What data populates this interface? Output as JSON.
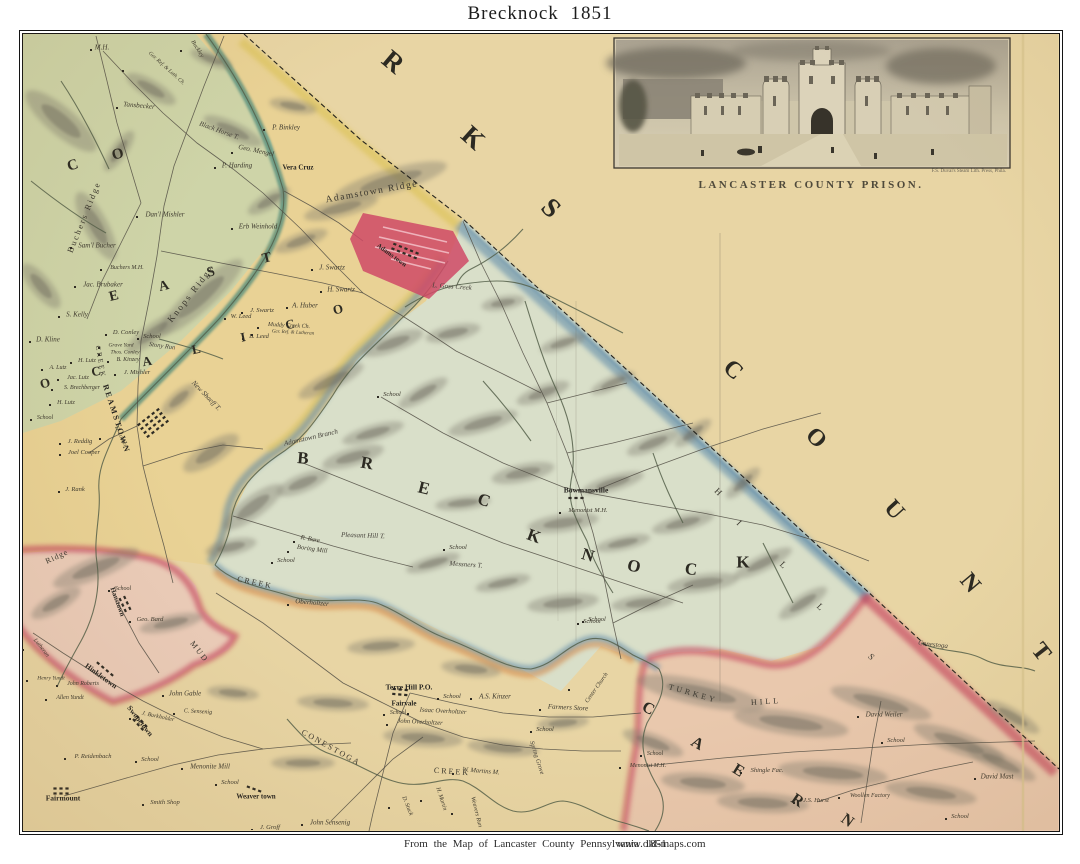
{
  "page": {
    "title": "Brecknock  1851",
    "footer_caption": "From the Map of Lancaster County   Pennsylvania   1851",
    "footer_url": "www.old-maps.com"
  },
  "inset": {
    "caption": "LANCASTER COUNTY PRISON.",
    "credit": "F.S. Duval's Steam Lith. Press, Phila."
  },
  "palette": {
    "paper": "#e8d5a4",
    "east_cocalico": "#e9d193",
    "brecknock": "#d9dfc9",
    "west_cocalico": "#cbd4a8",
    "ephrata_pink": "#ebc9be",
    "caernarvon": "#e9c6ae",
    "adamstown_red": "#cf4a66",
    "boundary_red": "#c6485f",
    "boundary_blue": "#4a7ca3",
    "boundary_yellow": "#d8bf4a",
    "boundary_orange": "#d6823f",
    "creek_teal": "#4e8a7a",
    "ink": "#2e2b24"
  },
  "labels": [
    {
      "t": "R",
      "x": 393,
      "y": 62,
      "r": 40,
      "s": 27,
      "k": "big"
    },
    {
      "t": "K",
      "x": 473,
      "y": 138,
      "r": 42,
      "s": 27,
      "k": "big"
    },
    {
      "t": "S",
      "x": 551,
      "y": 208,
      "r": 45,
      "s": 27,
      "k": "big"
    },
    {
      "t": "C",
      "x": 733,
      "y": 370,
      "r": 42,
      "s": 24,
      "k": "big"
    },
    {
      "t": "O",
      "x": 816,
      "y": 438,
      "r": 45,
      "s": 24,
      "k": "big"
    },
    {
      "t": "U",
      "x": 894,
      "y": 510,
      "r": 48,
      "s": 24,
      "k": "big"
    },
    {
      "t": "N",
      "x": 970,
      "y": 583,
      "r": 50,
      "s": 24,
      "k": "big"
    },
    {
      "t": "T",
      "x": 1041,
      "y": 652,
      "r": 52,
      "s": 24,
      "k": "big"
    },
    {
      "t": "B",
      "x": 303,
      "y": 458,
      "r": 5,
      "s": 17,
      "k": "big"
    },
    {
      "t": "R",
      "x": 367,
      "y": 463,
      "r": 10,
      "s": 17,
      "k": "big"
    },
    {
      "t": "E",
      "x": 424,
      "y": 488,
      "r": 14,
      "s": 17,
      "k": "big"
    },
    {
      "t": "C",
      "x": 484,
      "y": 500,
      "r": 18,
      "s": 17,
      "k": "big"
    },
    {
      "t": "K",
      "x": 534,
      "y": 536,
      "r": 20,
      "s": 17,
      "k": "big"
    },
    {
      "t": "N",
      "x": 588,
      "y": 555,
      "r": 16,
      "s": 17,
      "k": "big"
    },
    {
      "t": "O",
      "x": 634,
      "y": 566,
      "r": 12,
      "s": 17,
      "k": "big"
    },
    {
      "t": "C",
      "x": 691,
      "y": 569,
      "r": 6,
      "s": 17,
      "k": "big"
    },
    {
      "t": "K",
      "x": 743,
      "y": 562,
      "r": 0,
      "s": 17,
      "k": "big"
    },
    {
      "t": "E",
      "x": 114,
      "y": 297,
      "r": -14,
      "s": 14,
      "k": "big"
    },
    {
      "t": "A",
      "x": 164,
      "y": 287,
      "r": -14,
      "s": 14,
      "k": "big"
    },
    {
      "t": "S",
      "x": 211,
      "y": 273,
      "r": -14,
      "s": 14,
      "k": "big"
    },
    {
      "t": "T",
      "x": 267,
      "y": 259,
      "r": -14,
      "s": 14,
      "k": "big"
    },
    {
      "t": "C",
      "x": 16,
      "y": 330,
      "r": -30,
      "s": 13,
      "k": "big"
    },
    {
      "t": "O",
      "x": 45,
      "y": 383,
      "r": -15,
      "s": 13,
      "k": "big"
    },
    {
      "t": "C",
      "x": 96,
      "y": 371,
      "r": -10,
      "s": 13,
      "k": "big"
    },
    {
      "t": "A",
      "x": 147,
      "y": 361,
      "r": -10,
      "s": 13,
      "k": "big"
    },
    {
      "t": "L",
      "x": 196,
      "y": 349,
      "r": -12,
      "s": 13,
      "k": "big"
    },
    {
      "t": "I",
      "x": 243,
      "y": 337,
      "r": -12,
      "s": 13,
      "k": "big"
    },
    {
      "t": "C",
      "x": 290,
      "y": 324,
      "r": -13,
      "s": 13,
      "k": "big"
    },
    {
      "t": "O",
      "x": 338,
      "y": 309,
      "r": -14,
      "s": 13,
      "k": "big"
    },
    {
      "t": "C",
      "x": 73,
      "y": 166,
      "r": -18,
      "s": 15,
      "k": "big"
    },
    {
      "t": "O",
      "x": 118,
      "y": 155,
      "r": -15,
      "s": 15,
      "k": "big"
    },
    {
      "t": "C",
      "x": 648,
      "y": 709,
      "r": 28,
      "s": 16,
      "k": "big"
    },
    {
      "t": "A",
      "x": 697,
      "y": 744,
      "r": 30,
      "s": 16,
      "k": "big"
    },
    {
      "t": "E",
      "x": 738,
      "y": 771,
      "r": 32,
      "s": 16,
      "k": "big"
    },
    {
      "t": "R",
      "x": 797,
      "y": 801,
      "r": 34,
      "s": 16,
      "k": "big"
    },
    {
      "t": "N",
      "x": 847,
      "y": 821,
      "r": 36,
      "s": 16,
      "k": "big"
    },
    {
      "t": "H",
      "x": 718,
      "y": 492,
      "r": 45,
      "s": 9,
      "k": "ridge"
    },
    {
      "t": "I",
      "x": 739,
      "y": 523,
      "r": 45,
      "s": 9,
      "k": "ridge"
    },
    {
      "t": "L",
      "x": 783,
      "y": 565,
      "r": 45,
      "s": 9,
      "k": "ridge"
    },
    {
      "t": "L",
      "x": 820,
      "y": 607,
      "r": 45,
      "s": 9,
      "k": "ridge"
    },
    {
      "t": "S",
      "x": 871,
      "y": 657,
      "r": 45,
      "s": 9,
      "k": "ridge"
    },
    {
      "t": "Adamstown Ridge",
      "x": 372,
      "y": 193,
      "r": -10,
      "s": 9.5,
      "k": "ridge",
      "ls": 1.5
    },
    {
      "t": "Knops Ridge",
      "x": 191,
      "y": 294,
      "r": -52,
      "s": 9,
      "k": "ridge",
      "ls": 2
    },
    {
      "t": "Buchers Ridge",
      "x": 84,
      "y": 217,
      "r": -68,
      "s": 8.5,
      "k": "ridge",
      "ls": 2
    },
    {
      "t": "Ridge",
      "x": 57,
      "y": 557,
      "r": -25,
      "s": 8,
      "k": "ridge",
      "ls": 1
    },
    {
      "t": "TURKEY",
      "x": 693,
      "y": 694,
      "r": 16,
      "s": 8,
      "k": "ridge",
      "ls": 3
    },
    {
      "t": "HILL",
      "x": 766,
      "y": 702,
      "r": -4,
      "s": 8,
      "k": "ridge",
      "ls": 3
    },
    {
      "t": "MUD",
      "x": 199,
      "y": 652,
      "r": 52,
      "s": 8,
      "k": "ridge",
      "ls": 2
    },
    {
      "t": "CREEK",
      "x": 255,
      "y": 583,
      "r": 12,
      "s": 8,
      "k": "ridge",
      "ls": 2
    },
    {
      "t": "CREEK",
      "x": 100,
      "y": 362,
      "r": 80,
      "s": 7,
      "k": "ridge",
      "ls": 2
    },
    {
      "t": "CONESTOGA",
      "x": 331,
      "y": 748,
      "r": 29,
      "s": 8,
      "k": "ridge",
      "ls": 2
    },
    {
      "t": "CREEK",
      "x": 452,
      "y": 772,
      "r": 4,
      "s": 8,
      "k": "ridge",
      "ls": 2
    },
    {
      "t": "Adamstown Branch",
      "x": 311,
      "y": 438,
      "r": -13,
      "k": "feat"
    },
    {
      "t": "L. Goss Creek",
      "x": 452,
      "y": 287,
      "r": 4,
      "k": "feat"
    },
    {
      "t": "Conestoga",
      "x": 933,
      "y": 645,
      "r": 6,
      "k": "feat"
    },
    {
      "t": "Stony Run",
      "x": 162,
      "y": 347,
      "r": 8,
      "s": 6.5,
      "k": "feat"
    },
    {
      "t": "Black Horse T.",
      "x": 219,
      "y": 131,
      "r": 20,
      "k": "feat"
    },
    {
      "t": "New Shaeff T.",
      "x": 206,
      "y": 396,
      "r": 46,
      "k": "feat"
    },
    {
      "t": "Pleasant Hill T.",
      "x": 363,
      "y": 536,
      "r": 2,
      "k": "feat"
    },
    {
      "t": "Messners T.",
      "x": 466,
      "y": 565,
      "r": 4,
      "k": "feat"
    },
    {
      "t": "Spring Grove",
      "x": 536,
      "y": 758,
      "r": 72,
      "s": 6.5,
      "k": "feat"
    },
    {
      "t": "Adams town",
      "x": 391,
      "y": 256,
      "r": 36,
      "s": 6.5,
      "k": "town"
    },
    {
      "t": "REAMSTOWN",
      "x": 116,
      "y": 419,
      "r": 72,
      "s": 8,
      "k": "town",
      "ls": 2
    },
    {
      "t": "Vera Cruz",
      "x": 298,
      "y": 168,
      "s": 7,
      "k": "town"
    },
    {
      "t": "Bowmansville",
      "x": 586,
      "y": 490,
      "s": 7.5,
      "k": "town"
    },
    {
      "t": "Terre Hill P.O.",
      "x": 409,
      "y": 687,
      "s": 7.5,
      "k": "town"
    },
    {
      "t": "Fairvale",
      "x": 404,
      "y": 704,
      "s": 7,
      "k": "town"
    },
    {
      "t": "Weaver town",
      "x": 256,
      "y": 797,
      "s": 7,
      "k": "town"
    },
    {
      "t": "Fairmount",
      "x": 63,
      "y": 798,
      "s": 7.5,
      "k": "town"
    },
    {
      "t": "Hinkletown",
      "x": 101,
      "y": 676,
      "r": 36,
      "s": 7.5,
      "k": "town"
    },
    {
      "t": "Swopetown",
      "x": 140,
      "y": 721,
      "r": 52,
      "s": 7.5,
      "k": "town"
    },
    {
      "t": "Hanstown",
      "x": 117,
      "y": 602,
      "r": 70,
      "s": 7,
      "k": "town"
    },
    {
      "t": "M.H.",
      "x": 102,
      "y": 48,
      "k": "name"
    },
    {
      "t": "Tansbecker",
      "x": 139,
      "y": 106,
      "r": 5,
      "k": "name"
    },
    {
      "t": "Ger. Ref. & Luth. Ch.",
      "x": 166,
      "y": 69,
      "r": 42,
      "s": 5.5,
      "k": "name"
    },
    {
      "t": "Buckley",
      "x": 197,
      "y": 49,
      "r": 58,
      "s": 6,
      "k": "name"
    },
    {
      "t": "P. Binkley",
      "x": 286,
      "y": 128,
      "k": "name"
    },
    {
      "t": "Geo. Mengel",
      "x": 256,
      "y": 151,
      "r": 12,
      "k": "name"
    },
    {
      "t": "P. Harding",
      "x": 237,
      "y": 166,
      "k": "name"
    },
    {
      "t": "Dan'l Mishler",
      "x": 165,
      "y": 215,
      "k": "name"
    },
    {
      "t": "Sam'l Bucher",
      "x": 97,
      "y": 246,
      "k": "name"
    },
    {
      "t": "Buchers M.H.",
      "x": 127,
      "y": 268,
      "s": 6,
      "k": "name"
    },
    {
      "t": "Jac. Brubaker",
      "x": 103,
      "y": 285,
      "k": "name"
    },
    {
      "t": "S. Kelly",
      "x": 77,
      "y": 315,
      "k": "name"
    },
    {
      "t": "D. Kline",
      "x": 48,
      "y": 340,
      "k": "name"
    },
    {
      "t": "D. Conley",
      "x": 126,
      "y": 333,
      "s": 6.5,
      "k": "name"
    },
    {
      "t": "School",
      "x": 152,
      "y": 337,
      "s": 6.5,
      "k": "name"
    },
    {
      "t": "Grave Yard",
      "x": 121,
      "y": 346,
      "s": 5.5,
      "k": "name"
    },
    {
      "t": "Thos. Conley",
      "x": 125,
      "y": 353,
      "s": 5.5,
      "k": "name"
    },
    {
      "t": "B. Kinzey",
      "x": 128,
      "y": 360,
      "s": 6,
      "k": "name"
    },
    {
      "t": "J. Mishler",
      "x": 137,
      "y": 373,
      "s": 6.5,
      "k": "name"
    },
    {
      "t": "H. Lutz",
      "x": 87,
      "y": 361,
      "s": 6,
      "k": "name"
    },
    {
      "t": "A. Lutz",
      "x": 58,
      "y": 368,
      "s": 6,
      "k": "name"
    },
    {
      "t": "Jac. Lutz",
      "x": 78,
      "y": 378,
      "s": 6,
      "k": "name"
    },
    {
      "t": "S. Brechberger",
      "x": 82,
      "y": 388,
      "s": 6,
      "k": "name"
    },
    {
      "t": "H. Lutz",
      "x": 66,
      "y": 403,
      "s": 6,
      "k": "name"
    },
    {
      "t": "School",
      "x": 45,
      "y": 418,
      "s": 6,
      "k": "name"
    },
    {
      "t": "D. Locher",
      "x": 120,
      "y": 437,
      "r": 65,
      "s": 5.5,
      "k": "name"
    },
    {
      "t": "J. Reddig",
      "x": 80,
      "y": 442,
      "s": 6.5,
      "k": "name"
    },
    {
      "t": "Joel Cooper",
      "x": 84,
      "y": 453,
      "s": 6.5,
      "k": "name"
    },
    {
      "t": "J. Rank",
      "x": 75,
      "y": 490,
      "s": 6.5,
      "k": "name"
    },
    {
      "t": "Erb Weinhold",
      "x": 258,
      "y": 227,
      "k": "name"
    },
    {
      "t": "J. Swartz",
      "x": 332,
      "y": 268,
      "k": "name"
    },
    {
      "t": "H. Swartz",
      "x": 341,
      "y": 290,
      "k": "name"
    },
    {
      "t": "A. Huber",
      "x": 305,
      "y": 306,
      "k": "name"
    },
    {
      "t": "J. Swartz",
      "x": 262,
      "y": 311,
      "s": 6.5,
      "k": "name"
    },
    {
      "t": "W. Leed",
      "x": 241,
      "y": 317,
      "s": 6.5,
      "k": "name"
    },
    {
      "t": "B. Leed",
      "x": 259,
      "y": 337,
      "s": 6.5,
      "k": "name"
    },
    {
      "t": "Muddy Creek Ch.",
      "x": 289,
      "y": 326,
      "r": 3,
      "s": 6,
      "k": "name"
    },
    {
      "t": "Ger. Ref. & Lutheran",
      "x": 293,
      "y": 333,
      "r": 3,
      "s": 5,
      "k": "name"
    },
    {
      "t": "School",
      "x": 392,
      "y": 395,
      "s": 6.5,
      "k": "name"
    },
    {
      "t": "R. Bare",
      "x": 310,
      "y": 540,
      "r": 10,
      "s": 6.5,
      "k": "name"
    },
    {
      "t": "Boring Mill",
      "x": 312,
      "y": 550,
      "r": 8,
      "s": 6.5,
      "k": "name"
    },
    {
      "t": "School",
      "x": 286,
      "y": 561,
      "s": 6.5,
      "k": "name"
    },
    {
      "t": "Oberholtzer",
      "x": 312,
      "y": 603,
      "r": 5,
      "k": "name"
    },
    {
      "t": "School",
      "x": 458,
      "y": 548,
      "s": 6.5,
      "k": "name"
    },
    {
      "t": "School",
      "x": 592,
      "y": 622,
      "s": 6.5,
      "k": "name"
    },
    {
      "t": "Menonist M.H.",
      "x": 588,
      "y": 511,
      "s": 6.5,
      "k": "name"
    },
    {
      "t": "School",
      "x": 398,
      "y": 713,
      "s": 6,
      "k": "name"
    },
    {
      "t": "Isaac Overholtzer",
      "x": 443,
      "y": 712,
      "r": 3,
      "s": 6.5,
      "k": "name"
    },
    {
      "t": "John Overholtzer",
      "x": 420,
      "y": 723,
      "r": 3,
      "s": 6.5,
      "k": "name"
    },
    {
      "t": "School",
      "x": 452,
      "y": 697,
      "s": 6.5,
      "k": "name"
    },
    {
      "t": "A.S. Kinzer",
      "x": 495,
      "y": 697,
      "k": "name"
    },
    {
      "t": "Farmers Store",
      "x": 568,
      "y": 708,
      "r": 3,
      "k": "name"
    },
    {
      "t": "School",
      "x": 545,
      "y": 730,
      "s": 6.5,
      "k": "name"
    },
    {
      "t": "Center Church",
      "x": 597,
      "y": 688,
      "r": -55,
      "s": 6,
      "k": "name"
    },
    {
      "t": "School",
      "x": 597,
      "y": 620,
      "s": 6.5,
      "k": "name"
    },
    {
      "t": "John Sensenig",
      "x": 330,
      "y": 823,
      "k": "name"
    },
    {
      "t": "W. Martins M.",
      "x": 481,
      "y": 772,
      "r": 5,
      "s": 6.5,
      "k": "name"
    },
    {
      "t": "H. Martin",
      "x": 441,
      "y": 799,
      "r": 72,
      "s": 6,
      "k": "name"
    },
    {
      "t": "D. Stuck",
      "x": 407,
      "y": 806,
      "r": 68,
      "s": 6,
      "k": "name"
    },
    {
      "t": "Weavers Run",
      "x": 476,
      "y": 812,
      "r": 76,
      "s": 6,
      "k": "name"
    },
    {
      "t": "John Gable",
      "x": 185,
      "y": 694,
      "k": "name"
    },
    {
      "t": "C. Sensenig",
      "x": 198,
      "y": 712,
      "r": 3,
      "s": 6,
      "k": "name"
    },
    {
      "t": "J. Burkholder",
      "x": 158,
      "y": 717,
      "r": 12,
      "s": 6,
      "k": "name"
    },
    {
      "t": "School",
      "x": 123,
      "y": 589,
      "s": 6,
      "k": "name"
    },
    {
      "t": "Geo. Bard",
      "x": 150,
      "y": 620,
      "s": 6.5,
      "k": "name"
    },
    {
      "t": "Lutheran",
      "x": 41,
      "y": 648,
      "r": 52,
      "s": 6,
      "k": "name"
    },
    {
      "t": "Henry Yundt",
      "x": 51,
      "y": 679,
      "s": 5.5,
      "k": "name"
    },
    {
      "t": "John Roberts",
      "x": 83,
      "y": 684,
      "s": 6,
      "k": "name"
    },
    {
      "t": "Allen Yundt",
      "x": 70,
      "y": 698,
      "s": 6,
      "k": "name"
    },
    {
      "t": "P. Reidenbach",
      "x": 93,
      "y": 757,
      "s": 6.5,
      "k": "name"
    },
    {
      "t": "School",
      "x": 150,
      "y": 760,
      "s": 6.5,
      "k": "name"
    },
    {
      "t": "Menonite Mill",
      "x": 210,
      "y": 767,
      "k": "name"
    },
    {
      "t": "School",
      "x": 230,
      "y": 783,
      "s": 6.5,
      "k": "name"
    },
    {
      "t": "Smith Shop",
      "x": 165,
      "y": 803,
      "s": 6.5,
      "k": "name"
    },
    {
      "t": "J. Groff",
      "x": 270,
      "y": 828,
      "s": 6.5,
      "k": "name"
    },
    {
      "t": "David Weiler",
      "x": 884,
      "y": 715,
      "k": "name"
    },
    {
      "t": "School",
      "x": 896,
      "y": 741,
      "s": 6.5,
      "k": "name"
    },
    {
      "t": "Shingle Fac.",
      "x": 767,
      "y": 771,
      "s": 6.5,
      "k": "name"
    },
    {
      "t": "J.S. Hurst",
      "x": 816,
      "y": 801,
      "s": 6.5,
      "k": "name"
    },
    {
      "t": "Woollen Factory",
      "x": 870,
      "y": 796,
      "s": 6,
      "k": "name"
    },
    {
      "t": "David Mast",
      "x": 997,
      "y": 777,
      "k": "name"
    },
    {
      "t": "School",
      "x": 960,
      "y": 817,
      "s": 6.5,
      "k": "name"
    },
    {
      "t": "Menonist M.H.",
      "x": 648,
      "y": 766,
      "s": 6,
      "k": "name"
    },
    {
      "t": "School",
      "x": 655,
      "y": 754,
      "s": 6,
      "k": "name"
    }
  ]
}
